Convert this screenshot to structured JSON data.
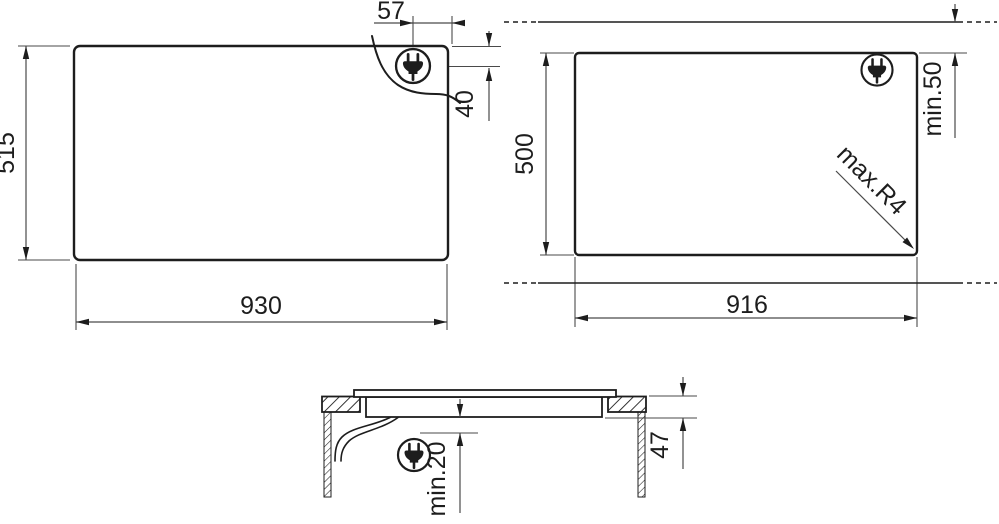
{
  "drawing": {
    "colors": {
      "line": "#1d1d1d",
      "dim": "#4a4a4a",
      "background": "#ffffff"
    },
    "top_view": {
      "hob_width_label": "930",
      "hob_depth_label": "515",
      "plug_offset_x_label": "57",
      "plug_offset_y_label": "40",
      "plug_icon": "power-plug-icon"
    },
    "cutout_view": {
      "cutout_width_label": "916",
      "cutout_depth_label": "500",
      "wall_clearance_label": "min.50",
      "corner_radius_label": "max.R4",
      "plug_icon": "power-plug-icon"
    },
    "section_view": {
      "installation_height_label": "47",
      "bottom_clearance_label": "min.20",
      "plug_icon": "power-plug-icon"
    }
  }
}
